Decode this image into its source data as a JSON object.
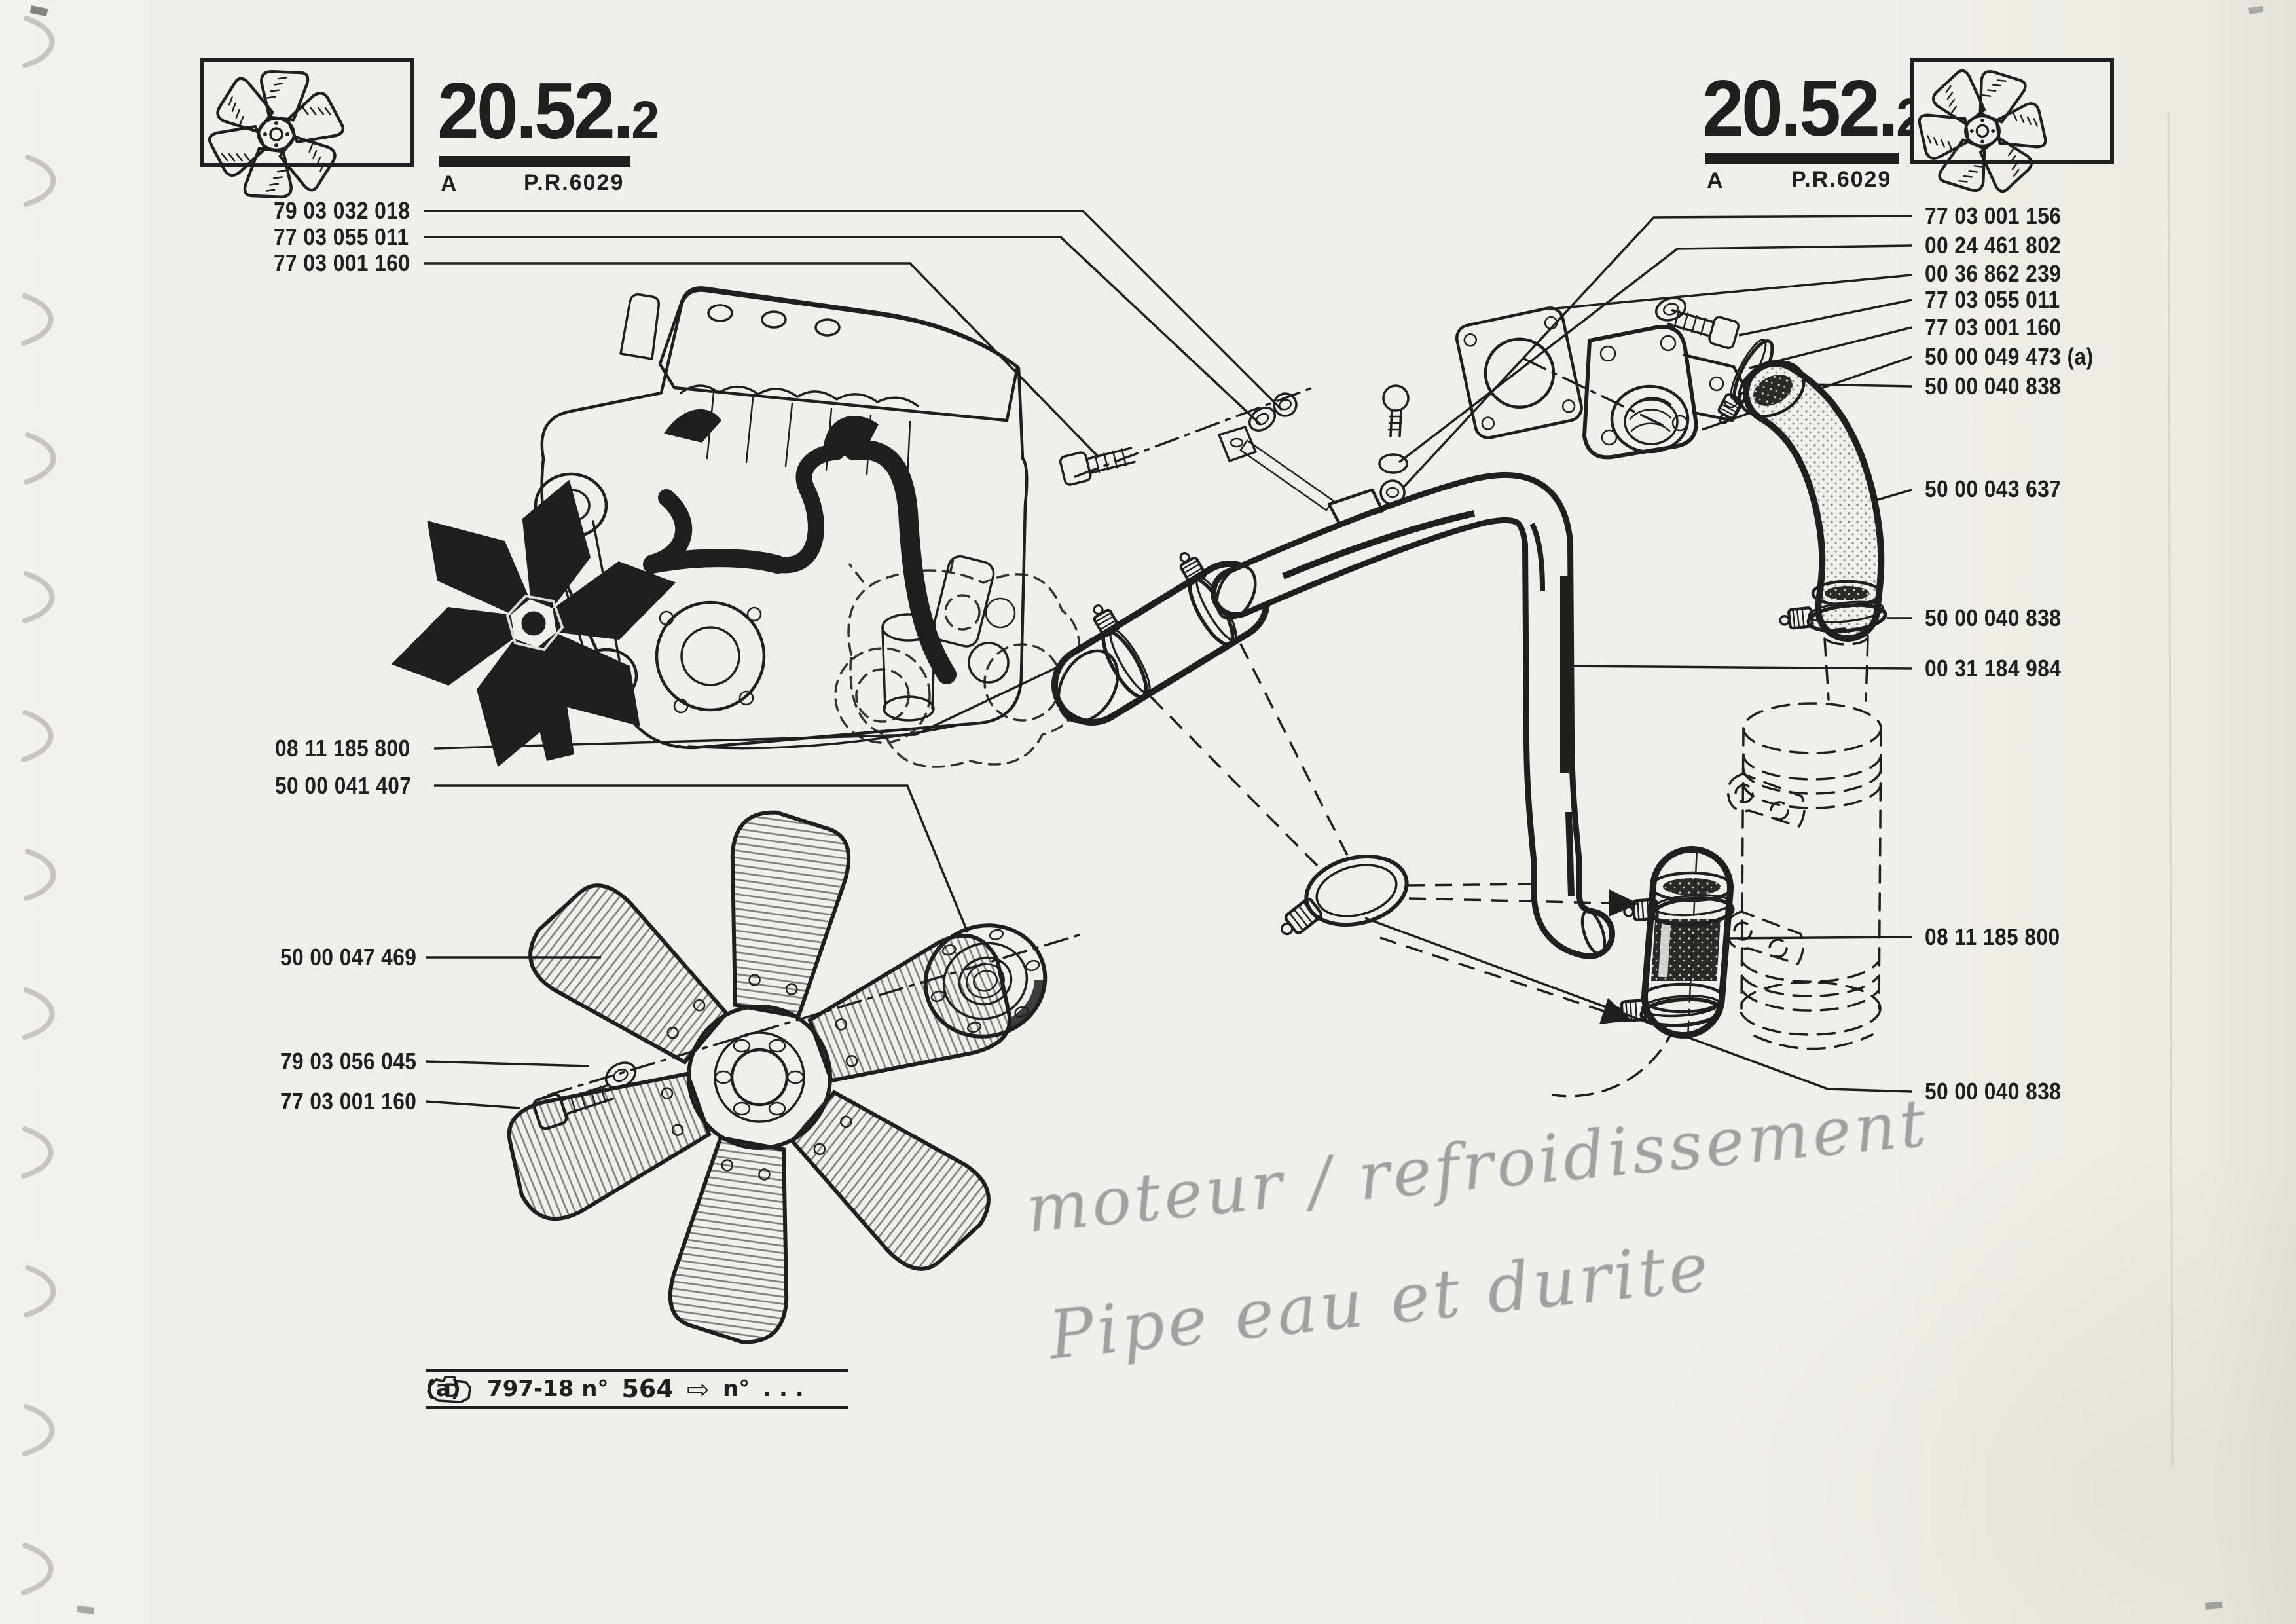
{
  "page": {
    "type": "scanned parts catalog plate",
    "colors": {
      "paper": "#f1efe9",
      "ink": "#1f1f1f",
      "pencil": "#8d8d90"
    }
  },
  "headers": {
    "left": {
      "code_main": "20.52.",
      "code_sub": "2",
      "revision": "A",
      "reference": "P.R.6029"
    },
    "right": {
      "code_main": "20.52.",
      "code_sub": "2",
      "revision": "A",
      "reference": "P.R.6029"
    }
  },
  "labels_left": [
    {
      "text": "79 03 032 018"
    },
    {
      "text": "77 03 055 011"
    },
    {
      "text": "77 03 001 160"
    },
    {
      "text": "08 11 185 800"
    },
    {
      "text": "50 00 041 407"
    },
    {
      "text": "50 00 047 469"
    },
    {
      "text": "79 03 056 045"
    },
    {
      "text": "77 03 001 160"
    }
  ],
  "labels_right": [
    {
      "text": "77 03 001 156"
    },
    {
      "text": "00 24 461 802"
    },
    {
      "text": "00 36 862 239"
    },
    {
      "text": "77 03 055 011"
    },
    {
      "text": "77 03 001 160"
    },
    {
      "text": "50 00 049 473 (a)"
    },
    {
      "text": "50 00 040 838"
    },
    {
      "text": "50 00 043 637"
    },
    {
      "text": "50 00 040 838"
    },
    {
      "text": "00 31 184 984"
    },
    {
      "text": "08 11 185 800"
    },
    {
      "text": "50 00 040 838"
    }
  ],
  "footnote": {
    "marker": "(a)",
    "engine_icon_letter": "D",
    "code": "797-18 n°",
    "number": "564",
    "arrow": "⇨",
    "suffix": "n°",
    "ellipsis": ". . ."
  },
  "handwriting": {
    "line1": "moteur / refroidissement",
    "line2": "Pipe eau et durite"
  }
}
